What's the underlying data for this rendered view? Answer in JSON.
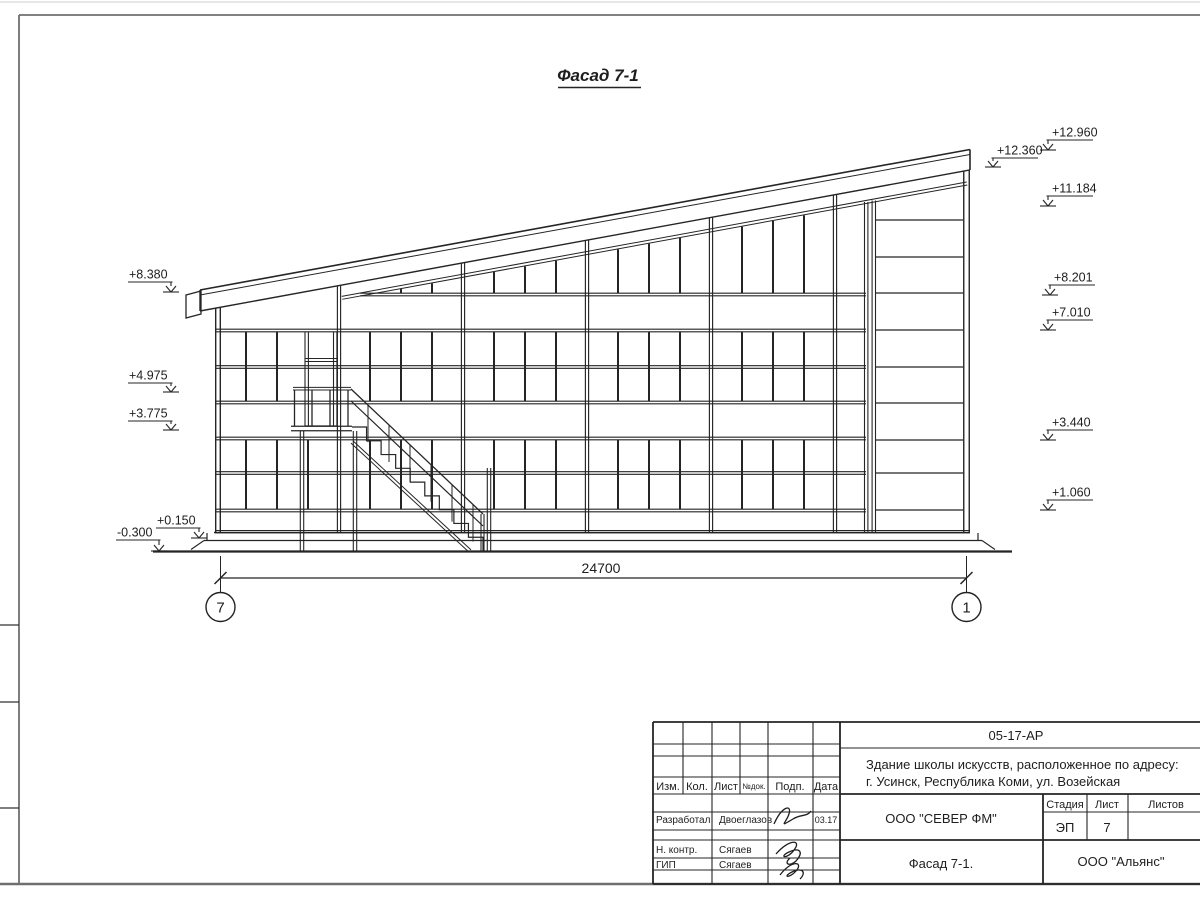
{
  "sheet": {
    "title": "Фасад 7-1"
  },
  "elevation_marks": {
    "left": [
      "+8.380",
      "+4.975",
      "+3.775",
      "+0.150",
      "-0.300"
    ],
    "right": [
      "+12.960",
      "+12.360",
      "+11.184",
      "+8.201",
      "+7.010",
      "+3.440",
      "+1.060"
    ]
  },
  "dimension": {
    "length": "24700"
  },
  "axes": {
    "left": "7",
    "right": "1"
  },
  "title_block": {
    "code": "05-17-АР",
    "project_line1": "Здание школы искусств, расположенное по адресу:",
    "project_line2": "г. Усинск, Республика Коми, ул. Возейская",
    "org": "ООО \"СЕВЕР ФМ\"",
    "org2": "ООО \"Альянс\"",
    "doc_title": "Фасад 7-1.",
    "stage_label": "Стадия",
    "sheet_label": "Лист",
    "sheets_label": "Листов",
    "stage_value": "ЭП",
    "sheet_value": "7",
    "header_cols": [
      "Изм.",
      "Кол.",
      "Лист",
      "№док.",
      "Подп.",
      "Дата"
    ],
    "rows": [
      {
        "role": "Разработал",
        "name": "Двоеглазов",
        "date": "03.17"
      },
      {
        "role": "Н. контр.",
        "name": "Сягаев",
        "date": ""
      },
      {
        "role": "ГИП",
        "name": "Сягаев",
        "date": ""
      }
    ]
  }
}
